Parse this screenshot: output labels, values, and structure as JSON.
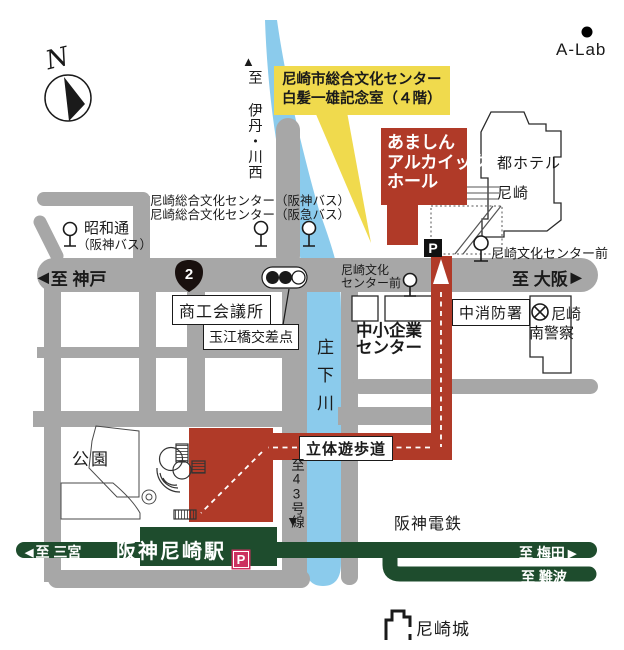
{
  "map": {
    "compass_label": "N",
    "alab_label": "A-Lab",
    "callout": {
      "line1": "尼崎市総合文化センター",
      "line2": "白髪一雄記念室（４階）"
    },
    "hall": {
      "line1": "あましん",
      "line2": "アルカイック",
      "line3": "ホール"
    },
    "hotel": {
      "line1": "都ホテル",
      "line2": "尼崎"
    },
    "bus_stops": {
      "center_hanshin": "尼崎総合文化センター（阪神バス）",
      "center_hankyu": "尼崎総合文化センター（阪急バス）",
      "showa_line1": "昭和通",
      "showa_line2": "（阪神バス）",
      "bunka_mae_line1": "尼崎文化",
      "bunka_mae_line2": "センター前",
      "bunka_mae_full": "尼崎文化センター前"
    },
    "roads": {
      "to_kobe": "至 神戸",
      "to_osaka": "至 大阪",
      "route2": "2",
      "to_itami": "至 伊丹・川西",
      "to_route43": "至43号線",
      "river_name": "庄下川"
    },
    "places": {
      "chamber": "商工会議所",
      "tamae": "玉江橋交差点",
      "sme_line1": "中小企業",
      "sme_line2": "センター",
      "fire": "中消防署",
      "police_line1": "尼崎",
      "police_line2": "南警察",
      "park": "公園",
      "walkway": "立体遊歩道",
      "castle": "尼崎城"
    },
    "railway": {
      "company": "阪神電鉄",
      "station": "阪神尼崎駅",
      "to_sannomiya": "至 三宮",
      "to_umeda": "至 梅田",
      "to_namba": "至 難波"
    },
    "parking_label": "P",
    "icons": {
      "up": "▲",
      "down": "▼",
      "left": "◀",
      "right": "▶"
    },
    "colors": {
      "road": "#a7a7a7",
      "river": "#8bcbec",
      "building_red": "#b03a28",
      "rail_green": "#1e4c2d",
      "highlight_yellow": "#f0da4d",
      "parking_pink": "#cc2f60"
    }
  }
}
